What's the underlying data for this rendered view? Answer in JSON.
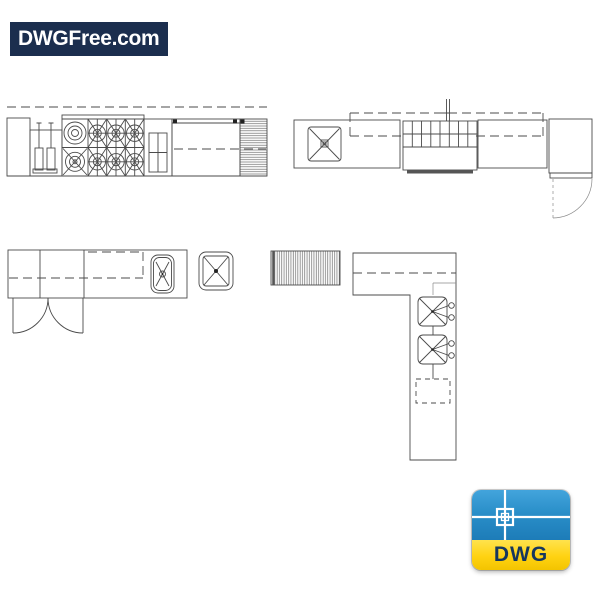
{
  "page": {
    "background_color": "#ffffff"
  },
  "logo": {
    "text": "DWGFree.com",
    "background_color": "#1b2e4e",
    "text_color": "#ffffff"
  },
  "dwg_badge": {
    "label": "DWG",
    "blue_color": "#2a8fc9",
    "yellow_color": "#ffd212",
    "label_color": "#16375e",
    "icon": "autocad-crosshair-icon"
  },
  "cad_drawings": {
    "line_color": "#4b4b4b",
    "items": [
      {
        "name": "range-counter-plan"
      },
      {
        "name": "sink-range-counter-with-door-plan"
      },
      {
        "name": "counter-with-double-door-plan"
      },
      {
        "name": "square-sink-unit-plan"
      },
      {
        "name": "hatched-drainboard-plan"
      },
      {
        "name": "l-shaped-counter-two-sinks-plan"
      }
    ]
  }
}
